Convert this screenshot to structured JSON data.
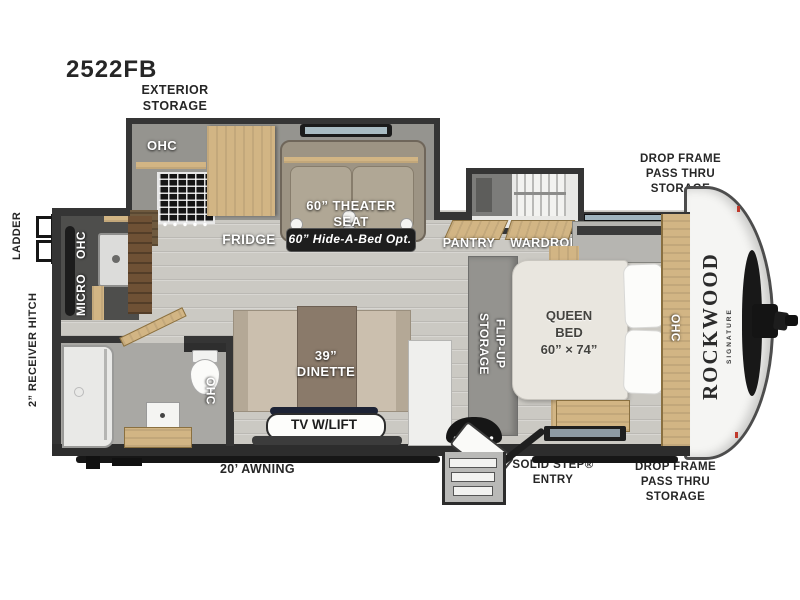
{
  "title": "2522FB",
  "front_cap": {
    "brand": "ROCKWOOD",
    "series": "SIGNATURE"
  },
  "exterior": {
    "exterior_storage": "EXTERIOR\nSTORAGE",
    "ladder": "LADDER",
    "receiver_hitch": "2” RECEIVER HITCH",
    "drop_frame_top": "DROP FRAME\nPASS THRU\nSTORAGE",
    "drop_frame_bottom": "DROP FRAME\nPASS THRU\nSTORAGE",
    "awning": "20’ AWNING",
    "solid_step_entry": "SOLID STEP®\nENTRY"
  },
  "kitchen": {
    "ohc": "OHC",
    "fridge": "FRIDGE",
    "rear_ohc": "OHC",
    "micro": "MICRO"
  },
  "living": {
    "theater_seat": "60” THEATER\nSEAT",
    "hide_a_bed": "60” Hide-A-Bed Opt.",
    "dinette": "39”\nDINETTE",
    "tv_lift": "TV W/LIFT"
  },
  "storage": {
    "pantry": "PANTRY",
    "wardrobe": "WARDROBE",
    "flip_up": "FLIP-UP\nSTORAGE"
  },
  "bedroom": {
    "queen_bed": "QUEEN\nBED\n60” × 74”",
    "ohc": "OHC"
  },
  "bathroom": {
    "ohc": "OHC"
  },
  "colors": {
    "wall": "#353535",
    "wood": "#d2b584",
    "floor": "#cbc9c3",
    "badge": "#1e1e1e",
    "accent_red": "#c0392b"
  }
}
